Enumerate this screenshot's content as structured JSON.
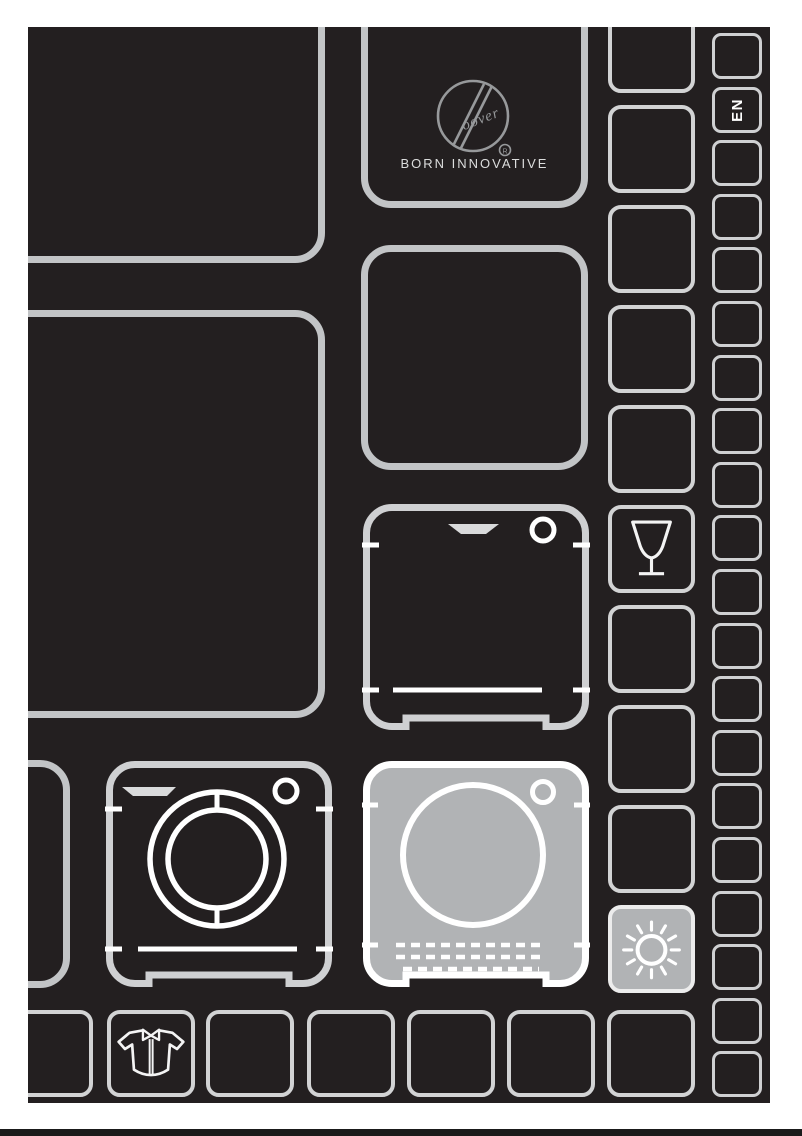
{
  "page": {
    "background_color": "#ffffff",
    "ink_color": "#231f20",
    "tile_stroke_color": "#c2c4c6",
    "small_tile_stroke_color": "#d2d3d4",
    "highlight_fill_color": "#b1b3b5",
    "icon_line_color": "#ffffff",
    "logo_line_color": "#97999b"
  },
  "brand": {
    "name": "Hoover",
    "registered_mark": "®",
    "tagline": "BORN INNOVATIVE"
  },
  "language": {
    "code": "EN"
  },
  "icons": [
    "dishwasher-icon",
    "washing-machine-icon",
    "tumble-dryer-icon",
    "wine-glass-icon",
    "sun-icon",
    "shirt-icon"
  ],
  "layout": {
    "language_column_tile_count": 20,
    "language_tile_index": 1,
    "side_column_tile_count": 10,
    "wine_glass_tile_index": 5,
    "sun_tile_index": 9
  }
}
